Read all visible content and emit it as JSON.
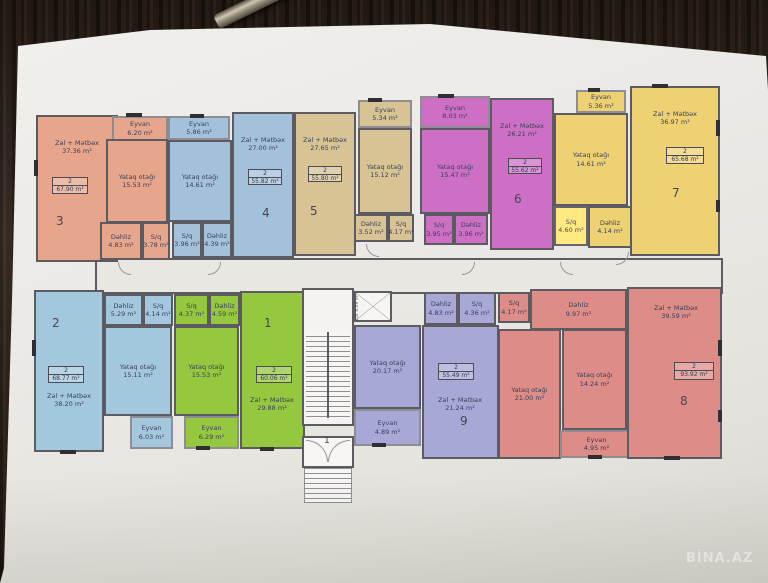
{
  "watermark": "BİNA.AZ",
  "colors": {
    "wall": "#5c5b61",
    "paper": "#ebe9e5",
    "corridor": "#e9e7e1"
  },
  "stairwell": {
    "lift": "Lift 6.09 m²",
    "entrance_number": "1"
  },
  "apartments": [
    {
      "id": "apt-3",
      "number": "3",
      "color": "#e7a68c",
      "badge": {
        "rooms": "2",
        "area": "67.90 m²"
      },
      "rooms": {
        "zal": {
          "label": "Zal + Mətbəx",
          "area": "37.36 m²"
        },
        "eyvan": {
          "label": "Eyvan",
          "area": "6.20 m²"
        },
        "yataq": {
          "label": "Yataq otağı",
          "area": "15.53 m²"
        },
        "dehliz": {
          "label": "Dəhliz",
          "area": "4.83 m²"
        },
        "sq": {
          "label": "S/q",
          "area": "3.78 m²"
        }
      }
    },
    {
      "id": "apt-4",
      "number": "4",
      "color": "#a4c1db",
      "badge": {
        "rooms": "2",
        "area": "55.82 m²"
      },
      "rooms": {
        "zal": {
          "label": "Zal + Mətbəx",
          "area": "27.00 m²"
        },
        "eyvan": {
          "label": "Eyvan",
          "area": "5.86 m²"
        },
        "yataq": {
          "label": "Yataq otağı",
          "area": "14.61 m²"
        },
        "sq": {
          "label": "S/q",
          "area": "3.96 m²"
        },
        "dehliz": {
          "label": "Dəhliz",
          "area": "4.39 m²"
        }
      }
    },
    {
      "id": "apt-5",
      "number": "5",
      "color": "#d7c394",
      "badge": {
        "rooms": "2",
        "area": "55.80 m²"
      },
      "rooms": {
        "zal": {
          "label": "Zal + Mətbəx",
          "area": "27.65 m²"
        },
        "eyvan": {
          "label": "Eyvan",
          "area": "5.34 m²"
        },
        "yataq": {
          "label": "Yataq otağı",
          "area": "15.12 m²"
        },
        "dehliz": {
          "label": "Dəhliz",
          "area": "3.52 m²"
        },
        "sq": {
          "label": "S/q",
          "area": "4.17 m²"
        }
      }
    },
    {
      "id": "apt-6",
      "number": "6",
      "color": "#cd70c5",
      "badge": {
        "rooms": "2",
        "area": "55.62 m²"
      },
      "rooms": {
        "zal": {
          "label": "Zal + Mətbəx",
          "area": "26.21 m²"
        },
        "eyvan": {
          "label": "Eyvan",
          "area": "8.03 m²"
        },
        "yataq": {
          "label": "Yataq otağı",
          "area": "15.47 m²"
        },
        "sq": {
          "label": "S/q",
          "area": "3.95 m²"
        },
        "dehliz": {
          "label": "Dəhliz",
          "area": "3.96 m²"
        }
      }
    },
    {
      "id": "apt-7",
      "number": "7",
      "color": "#eed173",
      "badge": {
        "rooms": "2",
        "area": "65.68 m²"
      },
      "rooms": {
        "zal": {
          "label": "Zal + Mətbəx",
          "area": "36.97 m²"
        },
        "eyvan": {
          "label": "Eyvan",
          "area": "5.36 m²"
        },
        "yataq": {
          "label": "Yataq otağı",
          "area": "14.61 m²"
        },
        "sq": {
          "label": "S/q",
          "area": "4.60 m²"
        },
        "dehliz": {
          "label": "Dəhliz",
          "area": "4.14 m²"
        }
      }
    },
    {
      "id": "apt-2",
      "number": "2",
      "color": "#a3c8de",
      "badge": {
        "rooms": "2",
        "area": "68.77 m²"
      },
      "rooms": {
        "zal": {
          "label": "Zal + Mətbəx",
          "area": "38.20 m²"
        },
        "dehliz": {
          "label": "Dəhliz",
          "area": "5.29 m²"
        },
        "sq": {
          "label": "S/q",
          "area": "4.14 m²"
        },
        "yataq": {
          "label": "Yataq otağı",
          "area": "15.11 m²"
        },
        "eyvan": {
          "label": "Eyvan",
          "area": "6.03 m²"
        }
      }
    },
    {
      "id": "apt-1",
      "number": "1",
      "color": "#95c73f",
      "badge": {
        "rooms": "2",
        "area": "60.06 m²"
      },
      "rooms": {
        "zal": {
          "label": "Zal + Mətbəx",
          "area": "29.88 m²"
        },
        "sq": {
          "label": "S/q",
          "area": "4.37 m²"
        },
        "dehliz": {
          "label": "Dəhliz",
          "area": "4.59 m²"
        },
        "yataq": {
          "label": "Yataq otağı",
          "area": "15.53 m²"
        },
        "eyvan": {
          "label": "Eyvan",
          "area": "6.29 m²"
        }
      }
    },
    {
      "id": "apt-9",
      "number": "9",
      "color": "#a8a8d6",
      "badge": {
        "rooms": "2",
        "area": "55.49 m²"
      },
      "rooms": {
        "zal": {
          "label": "Zal + Mətbəx",
          "area": "21.24 m²"
        },
        "dehliz": {
          "label": "Dəhliz",
          "area": "4.83 m²"
        },
        "sq": {
          "label": "S/q",
          "area": "4.36 m²"
        },
        "yataq": {
          "label": "Yataq otağı",
          "area": "20.17 m²"
        },
        "eyvan": {
          "label": "Eyvan",
          "area": "4.89 m²"
        }
      }
    },
    {
      "id": "apt-8",
      "number": "8",
      "color": "#de8c87",
      "badge": {
        "rooms": "2",
        "area": "93.92 m²"
      },
      "rooms": {
        "zal": {
          "label": "Zal + Mətbəx",
          "area": "39.59 m²"
        },
        "sq": {
          "label": "S/q",
          "area": "4.17 m²"
        },
        "dehliz": {
          "label": "Dəhliz",
          "area": "9.97 m²"
        },
        "yataq1": {
          "label": "Yataq otağı",
          "area": "21.00 m²"
        },
        "yataq2": {
          "label": "Yataq otağı",
          "area": "14.24 m²"
        },
        "eyvan": {
          "label": "Eyvan",
          "area": "4.95 m²"
        }
      }
    }
  ]
}
